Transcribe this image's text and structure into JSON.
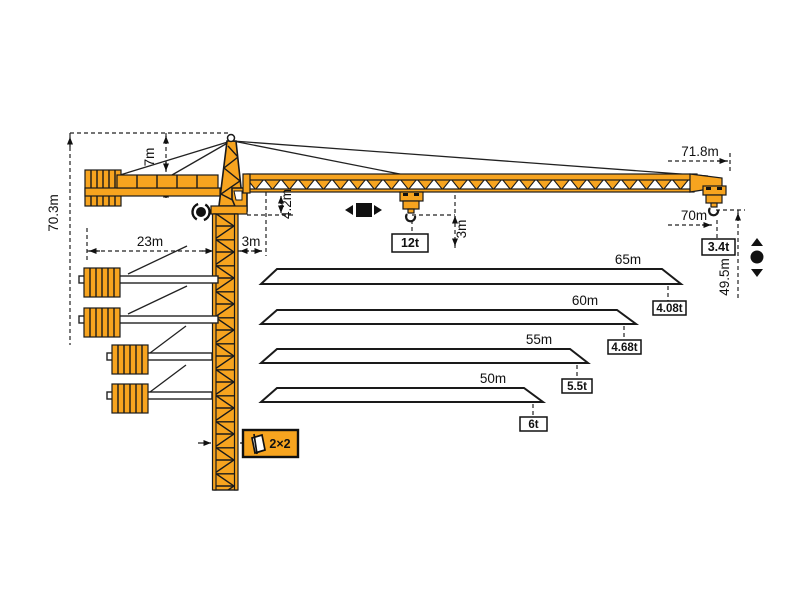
{
  "meta": {
    "type": "tower-crane-working-range-diagram"
  },
  "colors": {
    "crane_orange": "#F7A41F",
    "outline_black": "#1A1A1A",
    "dimension_line": "#222222",
    "background": "#FFFFFF"
  },
  "dimensions": {
    "total_height": "70.3m",
    "head_height": "7m",
    "counter_jib_radius": "23m",
    "rear_offset": "3m",
    "jib_depth": "4.2m",
    "hook_clearance": "3m",
    "max_load": "12t",
    "jib_tip_span": "71.8m",
    "max_working_radius": "70m",
    "tip_load": "3.4t",
    "hook_travel": "49.5m",
    "mast_section": "2×2"
  },
  "jib_variants": [
    {
      "length": "65m",
      "tip_load": "4.08t"
    },
    {
      "length": "60m",
      "tip_load": "4.68t"
    },
    {
      "length": "55m",
      "tip_load": "5.5t"
    },
    {
      "length": "50m",
      "tip_load": "6t"
    }
  ],
  "symbols": {
    "slewing": "slewing-rotation",
    "trolley_travel": "trolley-travel",
    "hoisting": "hook-up-down"
  }
}
